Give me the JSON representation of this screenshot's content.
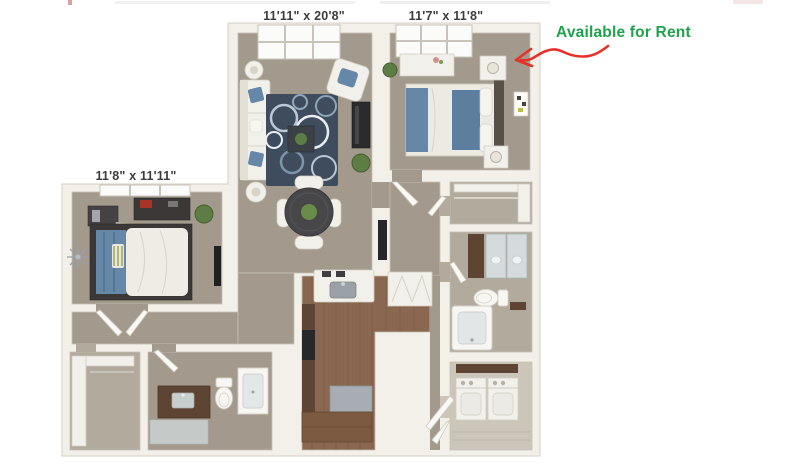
{
  "labels": {
    "living": "11'11\" x 20'8\"",
    "bedroom_right": "11'7\" x 11'8\"",
    "bedroom_left": "11'8\" x 11'11\""
  },
  "annotation": {
    "text": "Available for Rent",
    "text_color": "#1fa24c",
    "arrow_color": "#e5332b"
  },
  "palette": {
    "wall": "#f3f0e9",
    "wall_edge": "#d6d1c5",
    "carpet": "#a39a8d",
    "carpet_light": "#b2aa9d",
    "wood": "#8a6750",
    "wood_dark": "#5d4433",
    "rug": "#3f4c5e",
    "accent_blue": "#6587a8",
    "label_color": "#3c3c3c"
  }
}
